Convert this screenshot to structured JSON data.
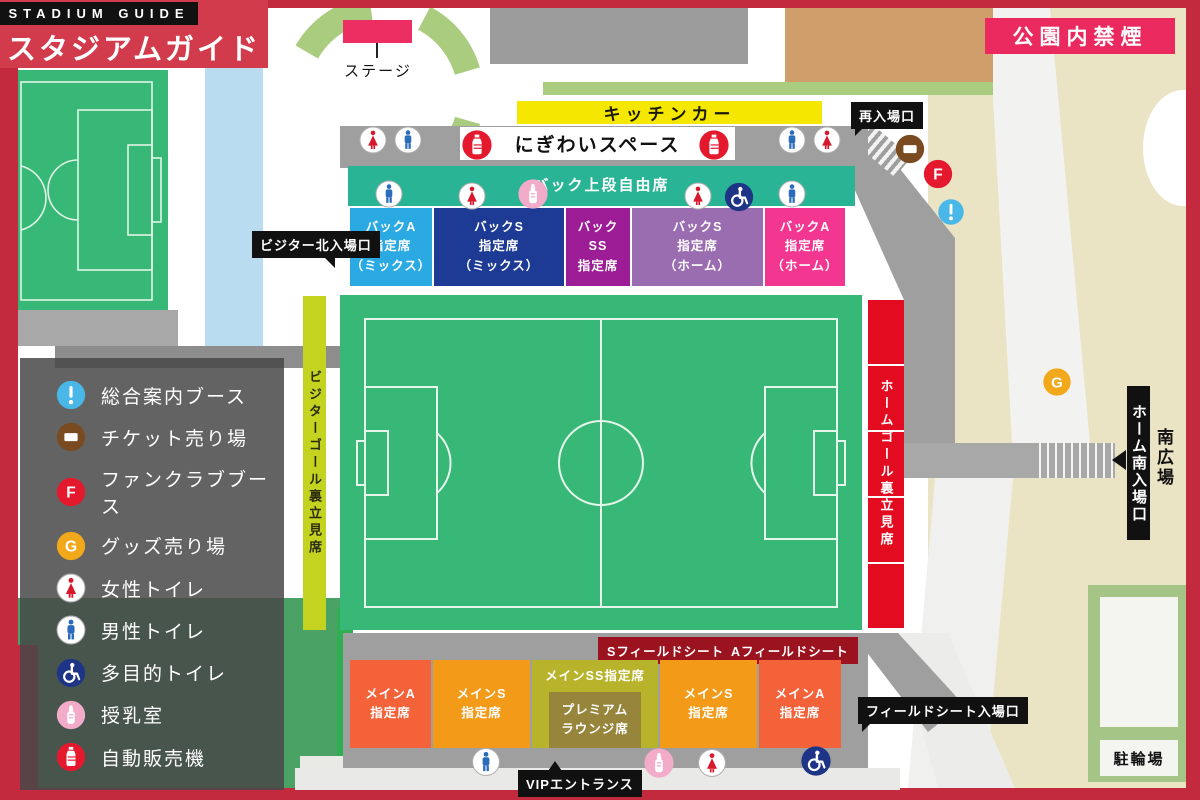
{
  "title_banner": {
    "brand_en": "STADIUM GUIDE",
    "brand_ja": "スタジアムガイド"
  },
  "no_smoking_label": "公園内禁煙",
  "map_labels": {
    "stage": "ステージ",
    "kitchen_car": "キッチンカー",
    "nigiwai_space": "にぎわいスペース",
    "back_upper_free_seats": "バック上段自由席",
    "south_plaza": "南広場",
    "bicycle_parking": "駐輪場"
  },
  "gates": {
    "visitor_north": "ビジター北入場口",
    "reentry": "再入場口",
    "home_south": "ホーム南入場口",
    "field_seat": "フィールドシート入場口",
    "vip_entrance": "VIPエントランス"
  },
  "stands": {
    "visitor_goal": {
      "label": "ビジターゴール裏立見席",
      "color": "#c3d320"
    },
    "home_goal": {
      "label": "ホームゴール裏立見席",
      "color": "#e30b20"
    }
  },
  "field_seat_labels": {
    "s": "Sフィールドシート",
    "a": "Aフィールドシート",
    "color": "#9c1320"
  },
  "seats": {
    "back_row": [
      {
        "id": "back-a-mix",
        "lines": [
          "バックA",
          "指定席",
          "（ミックス）"
        ],
        "color": "#2aa9e2",
        "x": 350,
        "w": 82
      },
      {
        "id": "back-s-mix",
        "lines": [
          "バックS",
          "指定席",
          "（ミックス）"
        ],
        "color": "#1d3a94",
        "x": 434,
        "w": 130
      },
      {
        "id": "back-ss",
        "lines": [
          "バック",
          "SS",
          "指定席"
        ],
        "color": "#9c1d96",
        "x": 566,
        "w": 64
      },
      {
        "id": "back-s-home",
        "lines": [
          "バックS",
          "指定席",
          "（ホーム）"
        ],
        "color": "#9a6cb0",
        "x": 632,
        "w": 131
      },
      {
        "id": "back-a-home",
        "lines": [
          "バックA",
          "指定席",
          "（ホーム）"
        ],
        "color": "#f3368f",
        "x": 765,
        "w": 80
      }
    ],
    "main_row": [
      {
        "id": "main-a-left",
        "lines": [
          "メインA",
          "指定席"
        ],
        "color": "#f4623a",
        "x": 350,
        "w": 81
      },
      {
        "id": "main-s-left",
        "lines": [
          "メインS",
          "指定席"
        ],
        "color": "#f49a19",
        "x": 433,
        "w": 97
      },
      {
        "id": "main-ss",
        "lines": [
          "メインSS指定席"
        ],
        "color": "#b7b32a",
        "x": 532,
        "w": 126,
        "align": "top"
      },
      {
        "id": "main-s-right",
        "lines": [
          "メインS",
          "指定席"
        ],
        "color": "#f49a19",
        "x": 660,
        "w": 97
      },
      {
        "id": "main-a-right",
        "lines": [
          "メインA",
          "指定席"
        ],
        "color": "#f4623a",
        "x": 759,
        "w": 82
      }
    ],
    "premium_lounge": {
      "id": "premium-lounge",
      "lines": [
        "プレミアム",
        "ラウンジ席"
      ],
      "color": "#97853c",
      "x": 549,
      "w": 92
    }
  },
  "legend": {
    "items": [
      {
        "icon": "info-icon",
        "label": "総合案内ブース"
      },
      {
        "icon": "ticket-icon",
        "label": "チケット売り場"
      },
      {
        "icon": "fanclub-icon",
        "label": "ファンクラブブース"
      },
      {
        "icon": "goods-icon",
        "label": "グッズ売り場"
      },
      {
        "icon": "female-toilet-icon",
        "label": "女性トイレ"
      },
      {
        "icon": "male-toilet-icon",
        "label": "男性トイレ"
      },
      {
        "icon": "accessible-toilet-icon",
        "label": "多目的トイレ"
      },
      {
        "icon": "nursing-room-icon",
        "label": "授乳室"
      },
      {
        "icon": "vending-machine-icon",
        "label": "自動販売機"
      }
    ]
  },
  "map_icons": [
    {
      "type": "female-toilet-icon",
      "x": 373,
      "y": 140,
      "s": 28
    },
    {
      "type": "male-toilet-icon",
      "x": 408,
      "y": 140,
      "s": 28
    },
    {
      "type": "vending-machine-icon",
      "x": 477,
      "y": 145,
      "s": 31
    },
    {
      "type": "vending-machine-icon",
      "x": 714,
      "y": 145,
      "s": 31
    },
    {
      "type": "male-toilet-icon",
      "x": 792,
      "y": 140,
      "s": 28
    },
    {
      "type": "female-toilet-icon",
      "x": 827,
      "y": 140,
      "s": 28
    },
    {
      "type": "male-toilet-icon",
      "x": 389,
      "y": 194,
      "s": 28
    },
    {
      "type": "female-toilet-icon",
      "x": 472,
      "y": 196,
      "s": 28
    },
    {
      "type": "nursing-room-icon",
      "x": 533,
      "y": 194,
      "s": 31
    },
    {
      "type": "female-toilet-icon",
      "x": 698,
      "y": 196,
      "s": 28
    },
    {
      "type": "accessible-toilet-icon",
      "x": 739,
      "y": 197,
      "s": 30
    },
    {
      "type": "male-toilet-icon",
      "x": 792,
      "y": 194,
      "s": 28
    },
    {
      "type": "ticket-icon",
      "x": 910,
      "y": 149,
      "s": 30
    },
    {
      "type": "fanclub-icon",
      "x": 938,
      "y": 174,
      "s": 30
    },
    {
      "type": "info-icon",
      "x": 951,
      "y": 212,
      "s": 27
    },
    {
      "type": "goods-icon",
      "x": 1057,
      "y": 382,
      "s": 29
    },
    {
      "type": "male-toilet-icon",
      "x": 486,
      "y": 762,
      "s": 29
    },
    {
      "type": "nursing-room-icon",
      "x": 659,
      "y": 763,
      "s": 31
    },
    {
      "type": "female-toilet-icon",
      "x": 712,
      "y": 763,
      "s": 29
    },
    {
      "type": "accessible-toilet-icon",
      "x": 816,
      "y": 761,
      "s": 31
    }
  ],
  "colors": {
    "road_red": "#c42a3d",
    "banner_red": "#d23b4c",
    "pink_accent": "#ea2a5f",
    "stage_pink": "#ed2e62",
    "pitch_green": "#38b877",
    "path_green": "#a9cc7e",
    "lawn_green": "#4aa264",
    "light_blue": "#badcf0",
    "beige": "#eae3c4",
    "tan": "#cf9e6b",
    "gray_concourse": "#9f9f9f",
    "kitchen_yellow": "#f6e700",
    "teal_free_seats": "#28b495",
    "legend_bg": "#4a4a4a"
  }
}
